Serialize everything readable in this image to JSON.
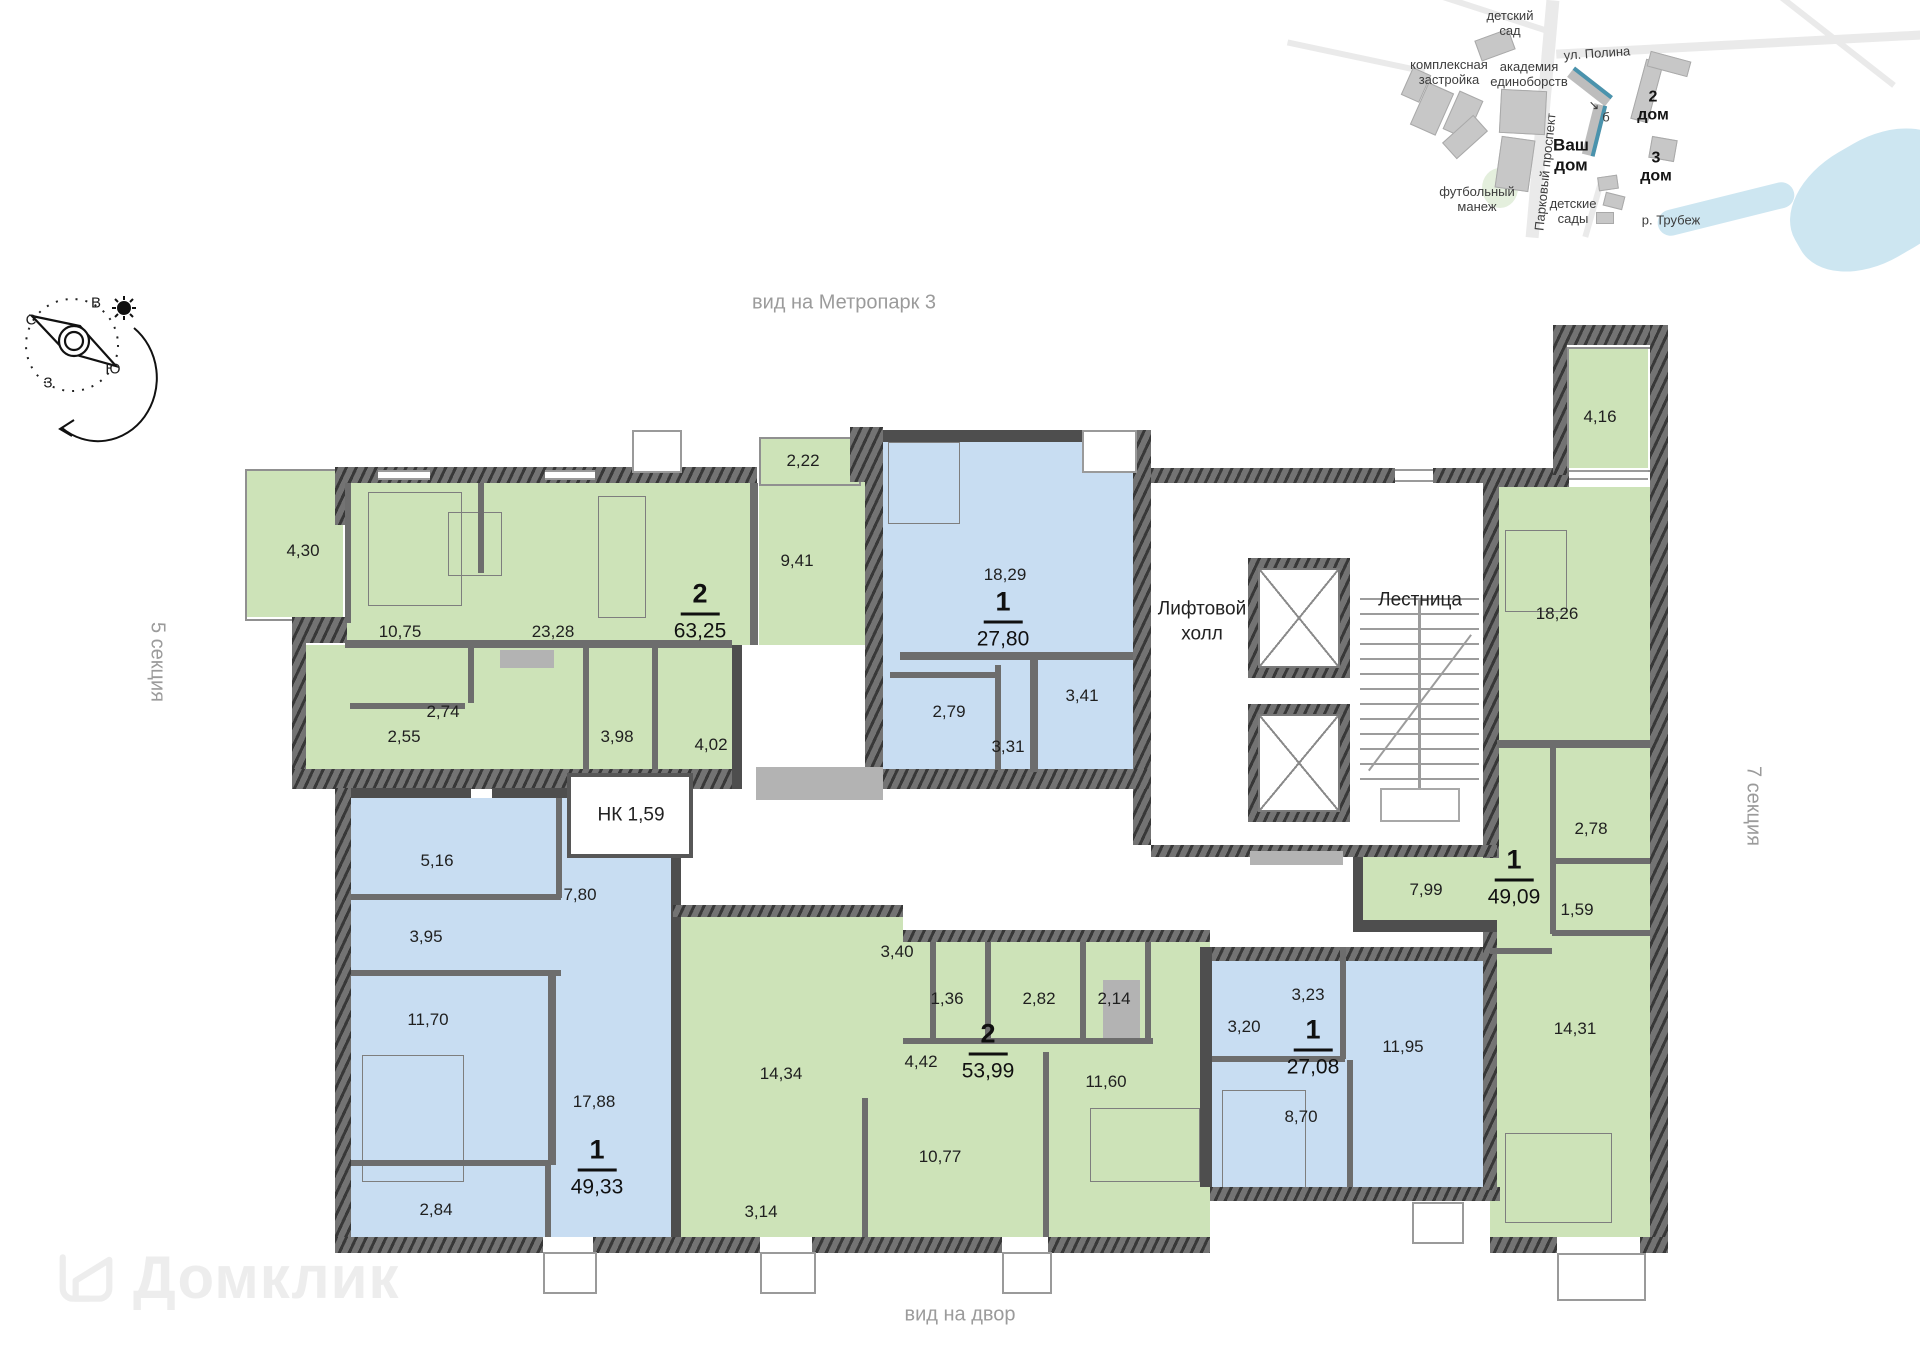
{
  "watermark": {
    "brand": "Домклик"
  },
  "view_labels": [
    {
      "t": "вид на Метропарк 3",
      "x": 844,
      "y": 303
    },
    {
      "t": "вид на двор",
      "x": 960,
      "y": 1315
    },
    {
      "t": "5 секция",
      "x": 157,
      "y": 662,
      "vert": true
    },
    {
      "t": "7 секция",
      "x": 1753,
      "y": 806,
      "vert": true
    }
  ],
  "compass": {
    "letters": [
      {
        "t": "С",
        "x": 31,
        "y": 320
      },
      {
        "t": "В",
        "x": 96,
        "y": 303
      },
      {
        "t": "Ю",
        "x": 113,
        "y": 369
      },
      {
        "t": "З",
        "x": 48,
        "y": 383
      }
    ]
  },
  "plan": {
    "core_labels": [
      {
        "t": "Лифтовой\nхолл",
        "x": 1202,
        "y": 622
      },
      {
        "t": "Лестница",
        "x": 1420,
        "y": 601
      },
      {
        "t": "НК 1,59",
        "x": 631,
        "y": 816
      }
    ],
    "apartments": [
      {
        "id": "apartment-2-6325",
        "type_label": "2",
        "area_label": "63,25",
        "label_x": 700,
        "label_y": 612,
        "rooms": [
          {
            "t": "4,30",
            "x": 303,
            "y": 551
          },
          {
            "t": "10,75",
            "x": 400,
            "y": 632
          },
          {
            "t": "23,28",
            "x": 553,
            "y": 632
          },
          {
            "t": "9,41",
            "x": 797,
            "y": 561
          },
          {
            "t": "2,22",
            "x": 803,
            "y": 461
          },
          {
            "t": "2,74",
            "x": 443,
            "y": 712
          },
          {
            "t": "2,55",
            "x": 404,
            "y": 737
          },
          {
            "t": "3,98",
            "x": 617,
            "y": 737
          },
          {
            "t": "4,02",
            "x": 711,
            "y": 745
          }
        ]
      },
      {
        "id": "apartment-1-2780",
        "type_label": "1",
        "area_label": "27,80",
        "label_x": 1003,
        "label_y": 620,
        "rooms": [
          {
            "t": "18,29",
            "x": 1005,
            "y": 575
          },
          {
            "t": "2,79",
            "x": 949,
            "y": 712
          },
          {
            "t": "3,31",
            "x": 1008,
            "y": 747
          },
          {
            "t": "3,41",
            "x": 1082,
            "y": 696
          }
        ]
      },
      {
        "id": "apartment-1-4909",
        "type_label": "1",
        "area_label": "49,09",
        "label_x": 1514,
        "label_y": 878,
        "rooms": [
          {
            "t": "4,16",
            "x": 1600,
            "y": 417
          },
          {
            "t": "18,26",
            "x": 1557,
            "y": 614
          },
          {
            "t": "2,78",
            "x": 1591,
            "y": 829
          },
          {
            "t": "1,59",
            "x": 1577,
            "y": 910
          },
          {
            "t": "7,99",
            "x": 1426,
            "y": 890
          },
          {
            "t": "14,31",
            "x": 1575,
            "y": 1029
          }
        ]
      },
      {
        "id": "apartment-1-4933",
        "type_label": "1",
        "area_label": "49,33",
        "label_x": 597,
        "label_y": 1168,
        "rooms": [
          {
            "t": "5,16",
            "x": 437,
            "y": 861
          },
          {
            "t": "3,95",
            "x": 426,
            "y": 937
          },
          {
            "t": "11,70",
            "x": 428,
            "y": 1020
          },
          {
            "t": "2,84",
            "x": 436,
            "y": 1210
          },
          {
            "t": "7,80",
            "x": 580,
            "y": 895
          },
          {
            "t": "17,88",
            "x": 594,
            "y": 1102
          }
        ]
      },
      {
        "id": "apartment-2-5399",
        "type_label": "2",
        "area_label": "53,99",
        "label_x": 988,
        "label_y": 1052,
        "rooms": [
          {
            "t": "14,34",
            "x": 781,
            "y": 1074
          },
          {
            "t": "3,40",
            "x": 897,
            "y": 952
          },
          {
            "t": "1,36",
            "x": 947,
            "y": 999
          },
          {
            "t": "2,82",
            "x": 1039,
            "y": 999
          },
          {
            "t": "2,14",
            "x": 1114,
            "y": 999
          },
          {
            "t": "4,42",
            "x": 921,
            "y": 1062
          },
          {
            "t": "11,60",
            "x": 1106,
            "y": 1082
          },
          {
            "t": "10,77",
            "x": 940,
            "y": 1157
          },
          {
            "t": "3,14",
            "x": 761,
            "y": 1212
          }
        ]
      },
      {
        "id": "apartment-1-2708",
        "type_label": "1",
        "area_label": "27,08",
        "label_x": 1313,
        "label_y": 1048,
        "rooms": [
          {
            "t": "3,20",
            "x": 1244,
            "y": 1027
          },
          {
            "t": "3,23",
            "x": 1308,
            "y": 995
          },
          {
            "t": "11,95",
            "x": 1403,
            "y": 1047
          },
          {
            "t": "8,70",
            "x": 1301,
            "y": 1117
          }
        ]
      }
    ]
  },
  "minimap": {
    "accent_color": "#4a93ad",
    "labels": [
      {
        "t": "детский\nсад",
        "x": 1510,
        "y": 24
      },
      {
        "t": "ул. Полина",
        "x": 1597,
        "y": 54,
        "r": -4
      },
      {
        "t": "комплексная\nзастройка",
        "x": 1449,
        "y": 73
      },
      {
        "t": "академия\nединоборств",
        "x": 1529,
        "y": 75
      },
      {
        "t": "Ваш\nдом",
        "x": 1571,
        "y": 155,
        "bold": true,
        "size": 17
      },
      {
        "t": "б",
        "x": 1606,
        "y": 118,
        "size": 13
      },
      {
        "t": "↘",
        "x": 1594,
        "y": 106,
        "size": 13
      },
      {
        "t": "2\nдом",
        "x": 1653,
        "y": 107,
        "bold": true,
        "size": 16
      },
      {
        "t": "3\nдом",
        "x": 1656,
        "y": 168,
        "bold": true,
        "size": 16
      },
      {
        "t": "футбольный\nманеж",
        "x": 1477,
        "y": 200
      },
      {
        "t": "Парковый проспект",
        "x": 1546,
        "y": 172,
        "r": -84
      },
      {
        "t": "детские\nсады",
        "x": 1573,
        "y": 212
      },
      {
        "t": "р. Трубеж",
        "x": 1671,
        "y": 221
      }
    ]
  }
}
